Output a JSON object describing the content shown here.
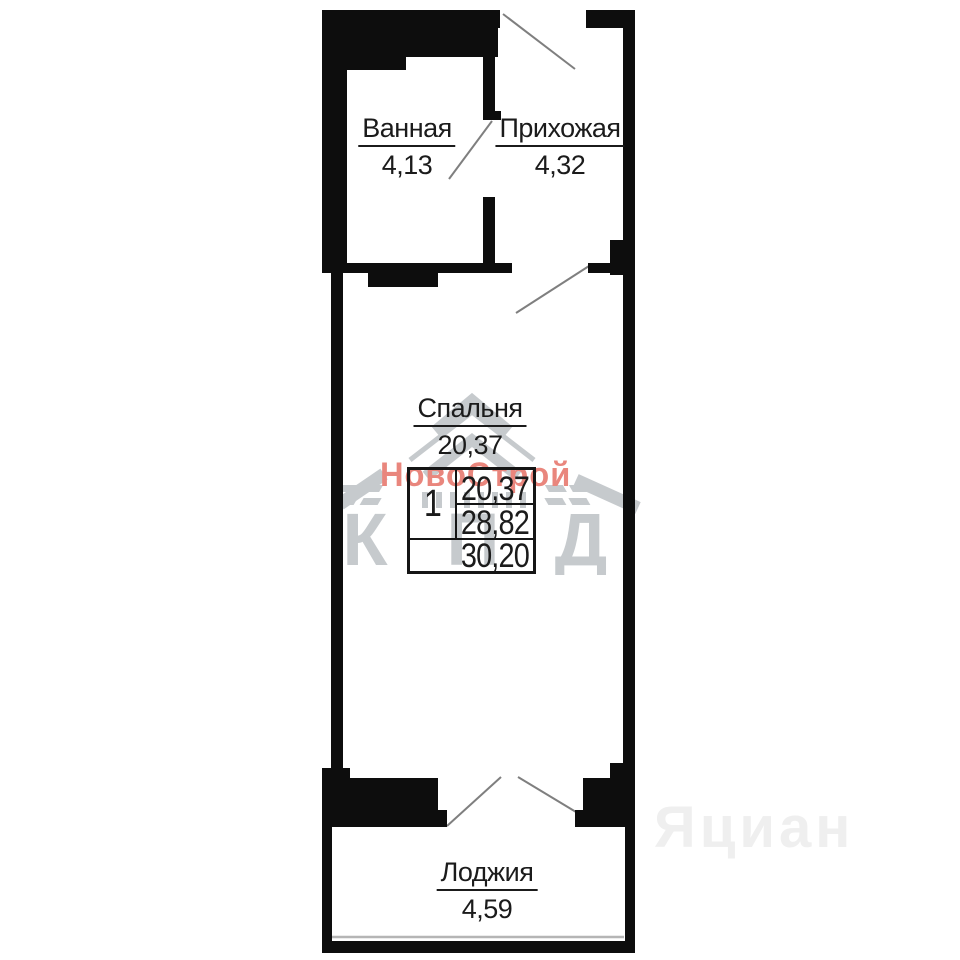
{
  "plan": {
    "rooms": [
      {
        "name": "Ванная",
        "area": "4,13"
      },
      {
        "name": "Прихожая",
        "area": "4,32"
      },
      {
        "name": "Спальня",
        "area": "20,37"
      },
      {
        "name": "Лоджия",
        "area": "4,59"
      }
    ],
    "summary_table": {
      "rooms_count": "1",
      "row1": "20,37",
      "row2": "28,82",
      "row3": "30,20"
    }
  },
  "watermarks": {
    "developer_name": "НовоСтрой",
    "developer_color": "#e9867d",
    "builder_logo_letters": {
      "k": "К",
      "p": "П",
      "d": "Д"
    },
    "builder_logo_color": "#c6cacd",
    "portal_name": "Яциан",
    "portal_color": "#efefef"
  },
  "colors": {
    "wall": "#0d0d0d",
    "door_line": "#7f7f7f",
    "window_line": "#b5b5b5"
  }
}
